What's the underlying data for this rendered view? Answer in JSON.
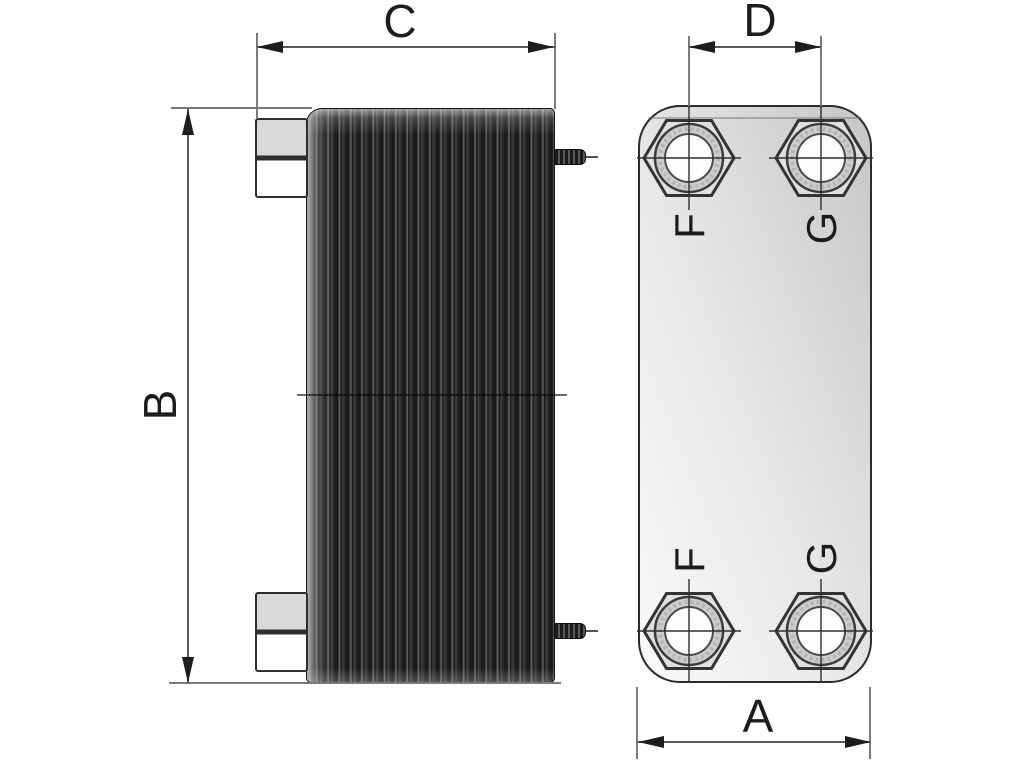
{
  "drawing": {
    "dim_labels": {
      "a": "A",
      "b": "B",
      "c": "C",
      "d": "D"
    },
    "port_labels": {
      "top_left": "F",
      "top_right": "G",
      "bottom_left": "F",
      "bottom_right": "G"
    }
  },
  "colors": {
    "background": "#ffffff",
    "dimension_line": "#5a5a5a",
    "extension_line": "#7a7a7a",
    "arrow": "#1d1d1d",
    "text": "#1c1c1c",
    "plate_pack_dark": "#1c1c1c",
    "plate_pack_highlight": "#6a6a6a",
    "front_plate_fill_light": "#fafafa",
    "front_plate_fill_dark": "#c6c6c6",
    "fitting_fill": "#d9d9d9",
    "port_ring_fill": "#cdcdcd",
    "port_bore_fill": "#fdfdfd",
    "hex_nut_fill": "#e0e0e0"
  }
}
